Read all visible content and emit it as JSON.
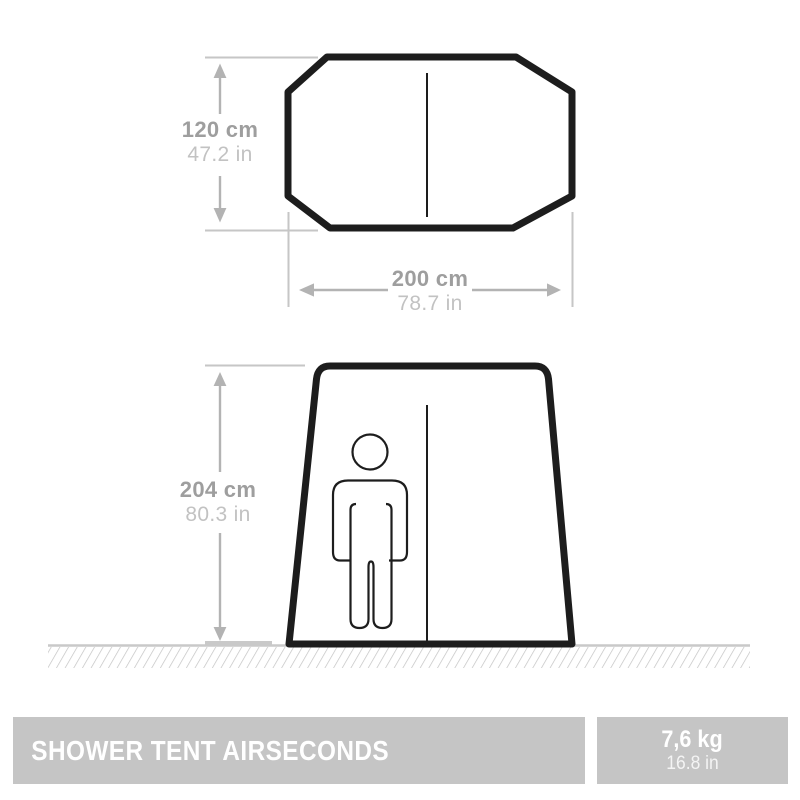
{
  "title_bar": {
    "product_name": "SHOWER TENT AIRSECONDS",
    "weight": {
      "primary": "7,6 kg",
      "secondary": "16.8 in"
    }
  },
  "top_view": {
    "depth": {
      "metric": "120 cm",
      "imperial": "47.2 in"
    },
    "width": {
      "metric": "200 cm",
      "imperial": "78.7 in"
    }
  },
  "front_view": {
    "height": {
      "metric": "204 cm",
      "imperial": "80.3 in"
    }
  },
  "icons": {
    "tent_top_view": "octagon-outline",
    "tent_front_view": "trapezoid-outline",
    "person": "standing-person-pictogram",
    "ground": "hatched-ground-band",
    "dimension_arrow": "double-headed-arrow"
  },
  "colors": {
    "outline": "#1d1d1d",
    "dimension_line": "#c6c6c6",
    "dimension_arrow": "#b3b3b3",
    "dimension_text_bold": "#9e9e9e",
    "dimension_text_light": "#c2c2c2",
    "ground_line": "#c9c9c9",
    "bar_background": "#c5c5c5",
    "bar_text": "#ffffff"
  }
}
